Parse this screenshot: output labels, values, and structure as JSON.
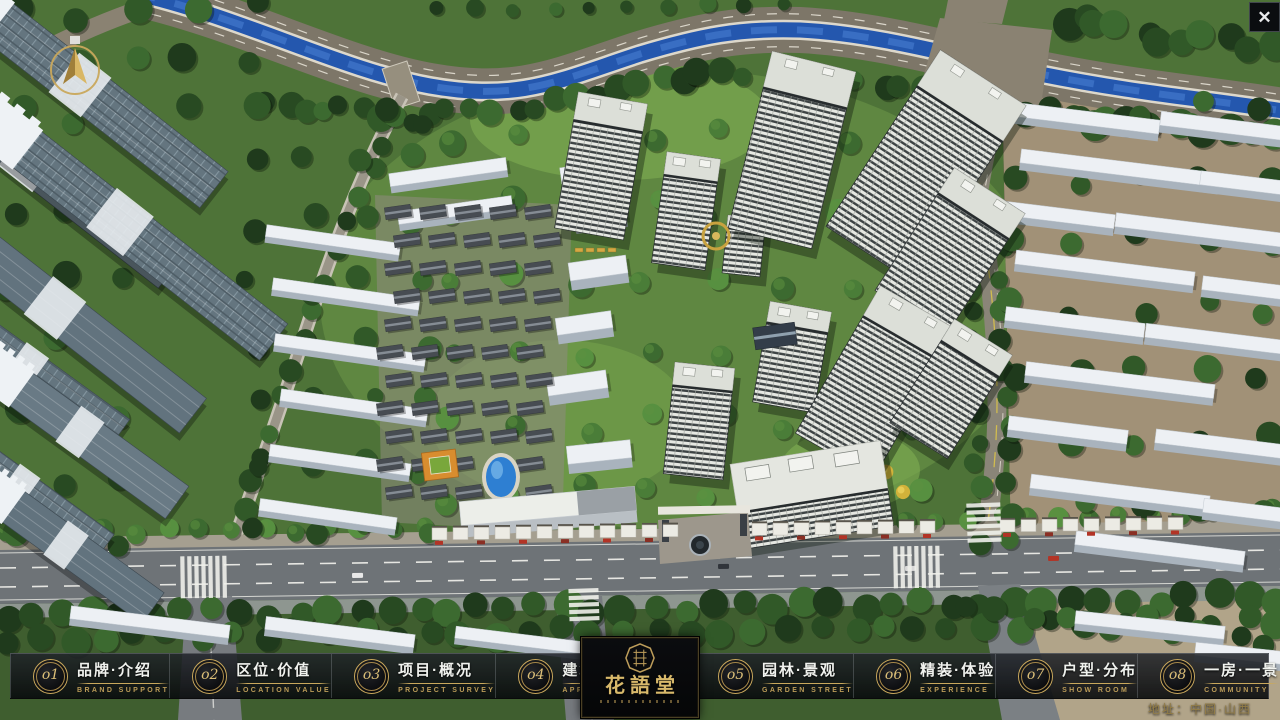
{
  "window": {
    "close_glyph": "✕"
  },
  "nav": {
    "items": [
      {
        "num": "o1",
        "zh": "品牌·介绍",
        "en": "BRAND SUPPORT"
      },
      {
        "num": "o2",
        "zh": "区位·价值",
        "en": "LOCATION VALUE"
      },
      {
        "num": "o3",
        "zh": "项目·概况",
        "en": "PROJECT SURVEY"
      },
      {
        "num": "o4",
        "zh": "建筑·鉴赏",
        "en": "APPRECIATION"
      },
      {
        "num": "o5",
        "zh": "园林·景观",
        "en": "GARDEN STREET"
      },
      {
        "num": "o6",
        "zh": "精装·体验",
        "en": "EXPERIENCE"
      },
      {
        "num": "o7",
        "zh": "户型·分布",
        "en": "SHOW ROOM"
      },
      {
        "num": "o8",
        "zh": "一房·一景",
        "en": "COMMUNITY"
      }
    ]
  },
  "logo": {
    "title": "花語堂"
  },
  "footer": {
    "address": "地址：中国·山西"
  },
  "colors": {
    "gold": "#c9a85c",
    "nav_bg": "#0c0e11",
    "water": "#2457ae"
  }
}
